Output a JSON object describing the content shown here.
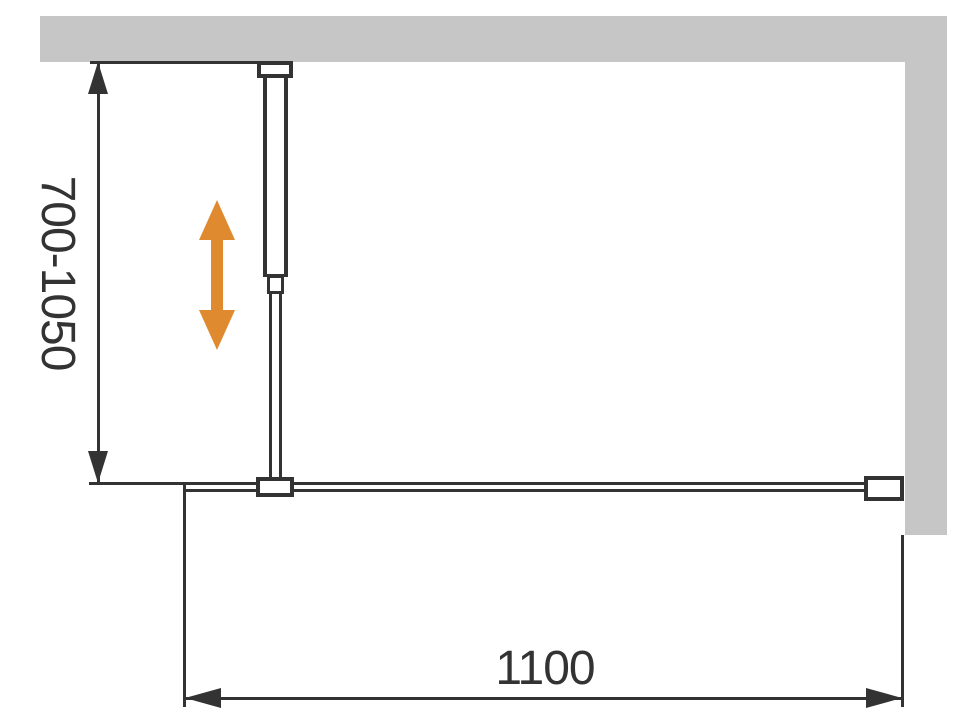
{
  "diagram": {
    "type": "technical-installation-drawing",
    "subject": "walk-in shower glass screen with adjustable support bar, top view",
    "labels": {
      "height_range": "700-1050",
      "width": "1100"
    },
    "icons": {
      "adjustment_arrow": "vertical-double-arrow-icon"
    },
    "colors": {
      "wall": "#c6c6c6",
      "line": "#333333",
      "accent": "#e08a30",
      "background": "#ffffff"
    }
  }
}
